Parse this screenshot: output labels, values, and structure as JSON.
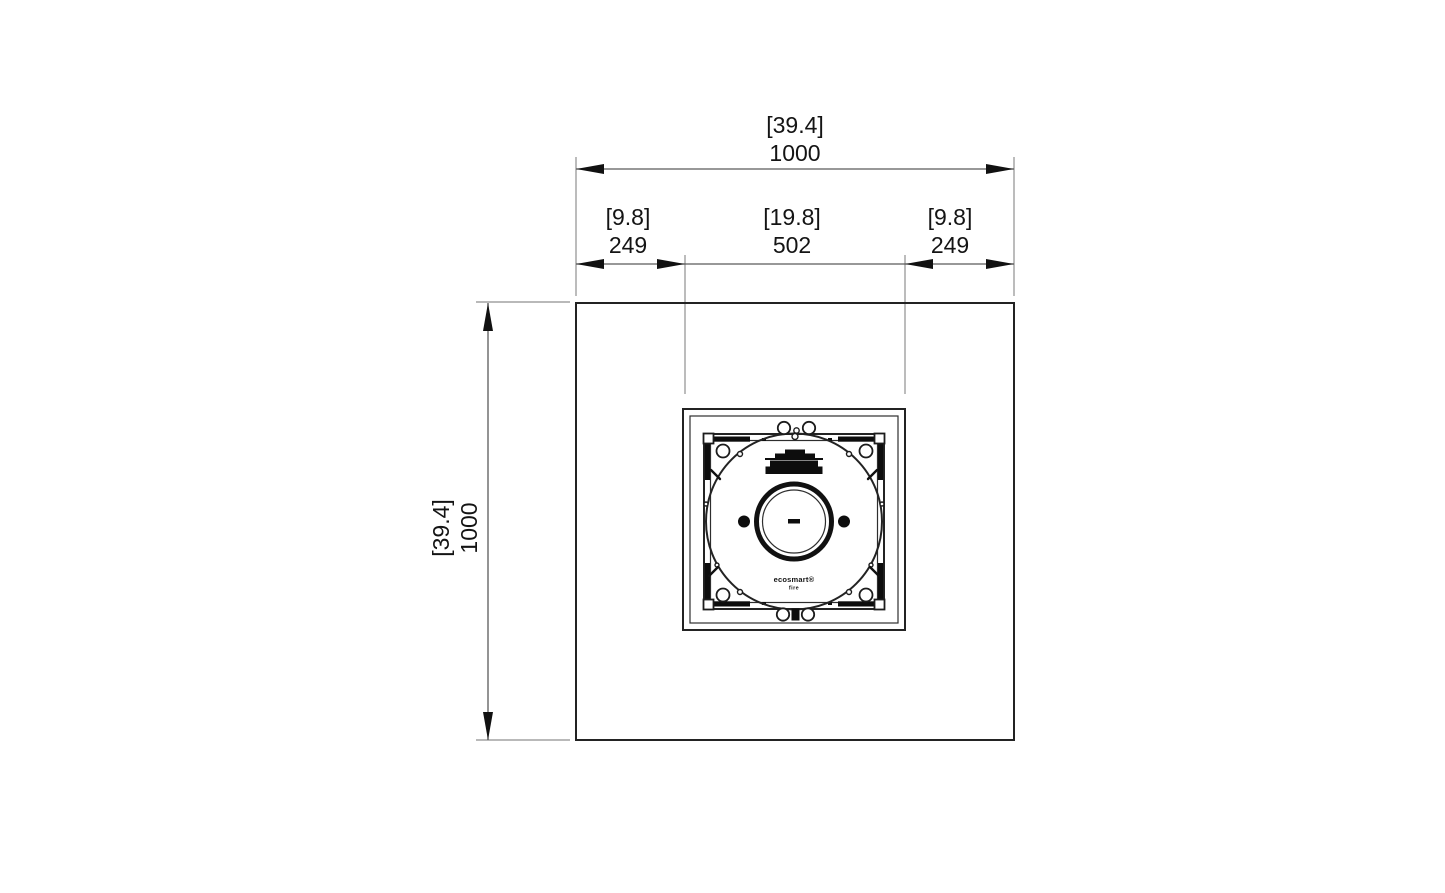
{
  "drawing": {
    "kind": "technical-dimension-drawing",
    "view": "plan view of square fire pit table with center burner insert"
  },
  "dimensions": {
    "top_overall": {
      "in": "[39.4]",
      "mm": "1000"
    },
    "top_left": {
      "in": "[9.8]",
      "mm": "249"
    },
    "top_center": {
      "in": "[19.8]",
      "mm": "502"
    },
    "top_right": {
      "in": "[9.8]",
      "mm": "249"
    },
    "side_overall": {
      "in": "[39.4]",
      "mm": "1000"
    }
  },
  "burner": {
    "brand": "ecosmart®",
    "brand_sub": "fire"
  },
  "colors": {
    "background": "#ffffff",
    "outline": "#232323",
    "dimension_line": "#5a5a5a",
    "witness_line": "#8f8f8f",
    "text": "#141414",
    "fill_black": "#0d0d0d"
  }
}
